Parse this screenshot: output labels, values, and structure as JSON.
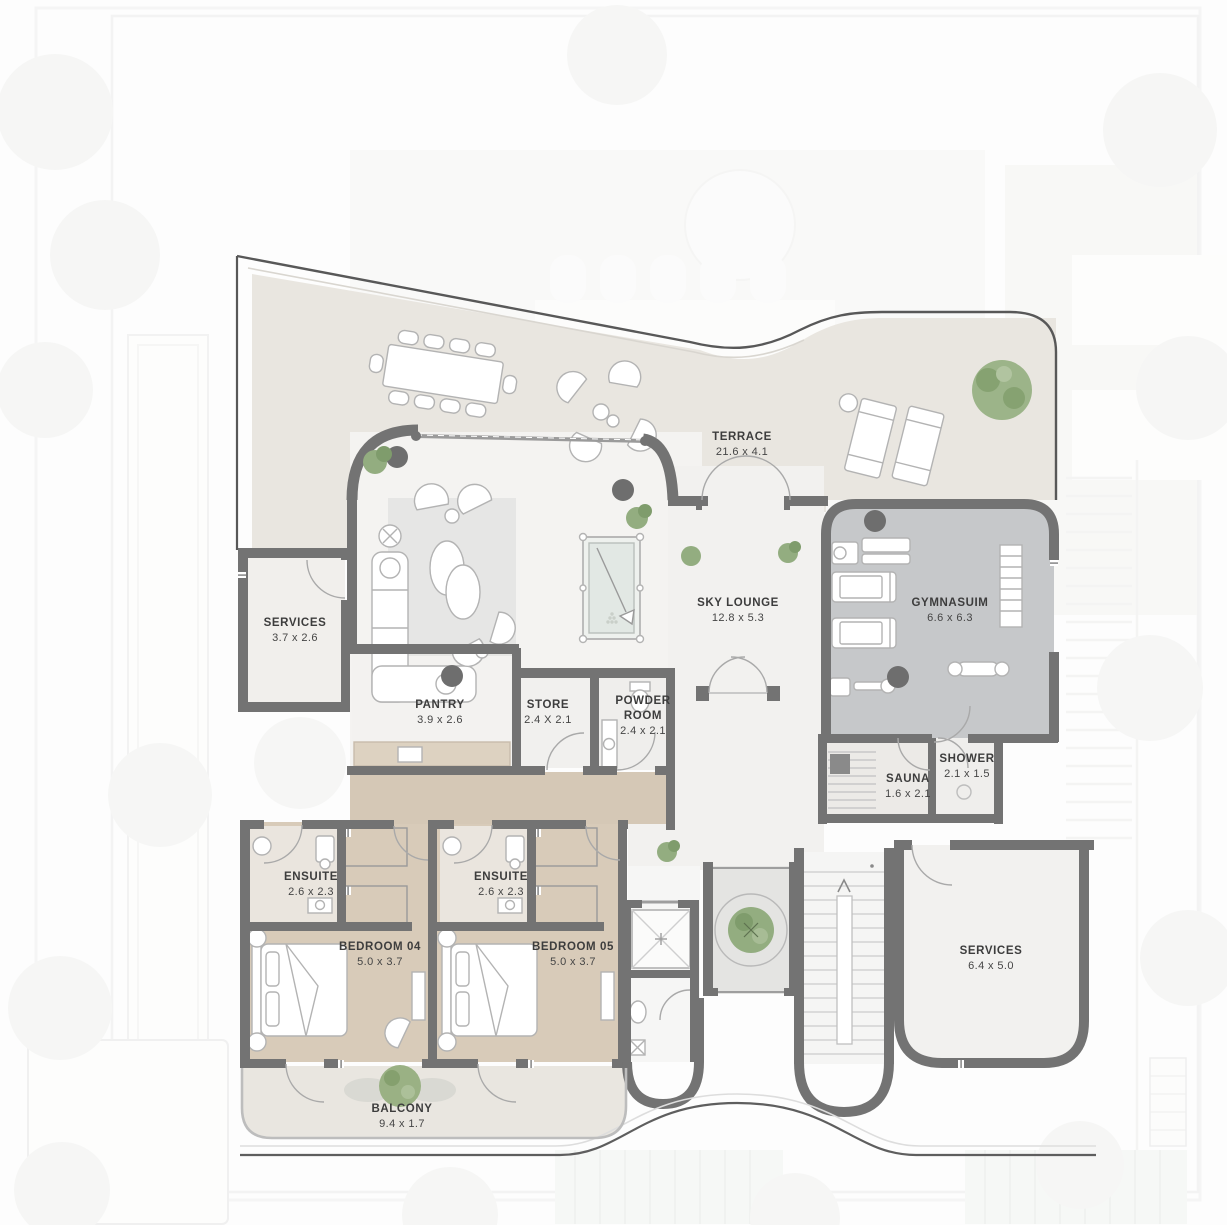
{
  "plan": {
    "rooms": [
      {
        "id": "terrace",
        "name": "TERRACE",
        "dims": "21.6 x 4.1"
      },
      {
        "id": "sky-lounge",
        "name": "SKY LOUNGE",
        "dims": "12.8 x 5.3"
      },
      {
        "id": "gymnasium",
        "name": "GYMNASUIM",
        "dims": "6.6 x 6.3"
      },
      {
        "id": "services-left",
        "name": "SERVICES",
        "dims": "3.7 x 2.6"
      },
      {
        "id": "pantry",
        "name": "PANTRY",
        "dims": "3.9 x 2.6"
      },
      {
        "id": "store",
        "name": "STORE",
        "dims": "2.4 X 2.1"
      },
      {
        "id": "powder-room",
        "name": "POWDER ROOM",
        "dims": "2.4 x 2.1"
      },
      {
        "id": "sauna",
        "name": "SAUNA",
        "dims": "1.6 x 2.1"
      },
      {
        "id": "shower",
        "name": "SHOWER",
        "dims": "2.1 x 1.5"
      },
      {
        "id": "ensuite-04",
        "name": "ENSUITE",
        "dims": "2.6 x 2.3"
      },
      {
        "id": "ensuite-05",
        "name": "ENSUITE",
        "dims": "2.6 x 2.3"
      },
      {
        "id": "bedroom-04",
        "name": "BEDROOM 04",
        "dims": "5.0 x 3.7"
      },
      {
        "id": "bedroom-05",
        "name": "BEDROOM 05",
        "dims": "5.0 x 3.7"
      },
      {
        "id": "services-right",
        "name": "SERVICES",
        "dims": "6.4 x 5.0"
      },
      {
        "id": "balcony",
        "name": "BALCONY",
        "dims": "9.4 x 1.7"
      }
    ],
    "colors": {
      "wall": "#737373",
      "terrace_floor": "#e9e6e0",
      "lounge_floor": "#f4f3f1",
      "gym_floor": "#c6c8ca",
      "bedroom_floor": "#d8cbb9",
      "ensuite_floor": "#eae5de",
      "courtyard_floor": "#e4e4e2",
      "plant_green": "#93ad80",
      "label_text": "#3d3d3d"
    }
  }
}
